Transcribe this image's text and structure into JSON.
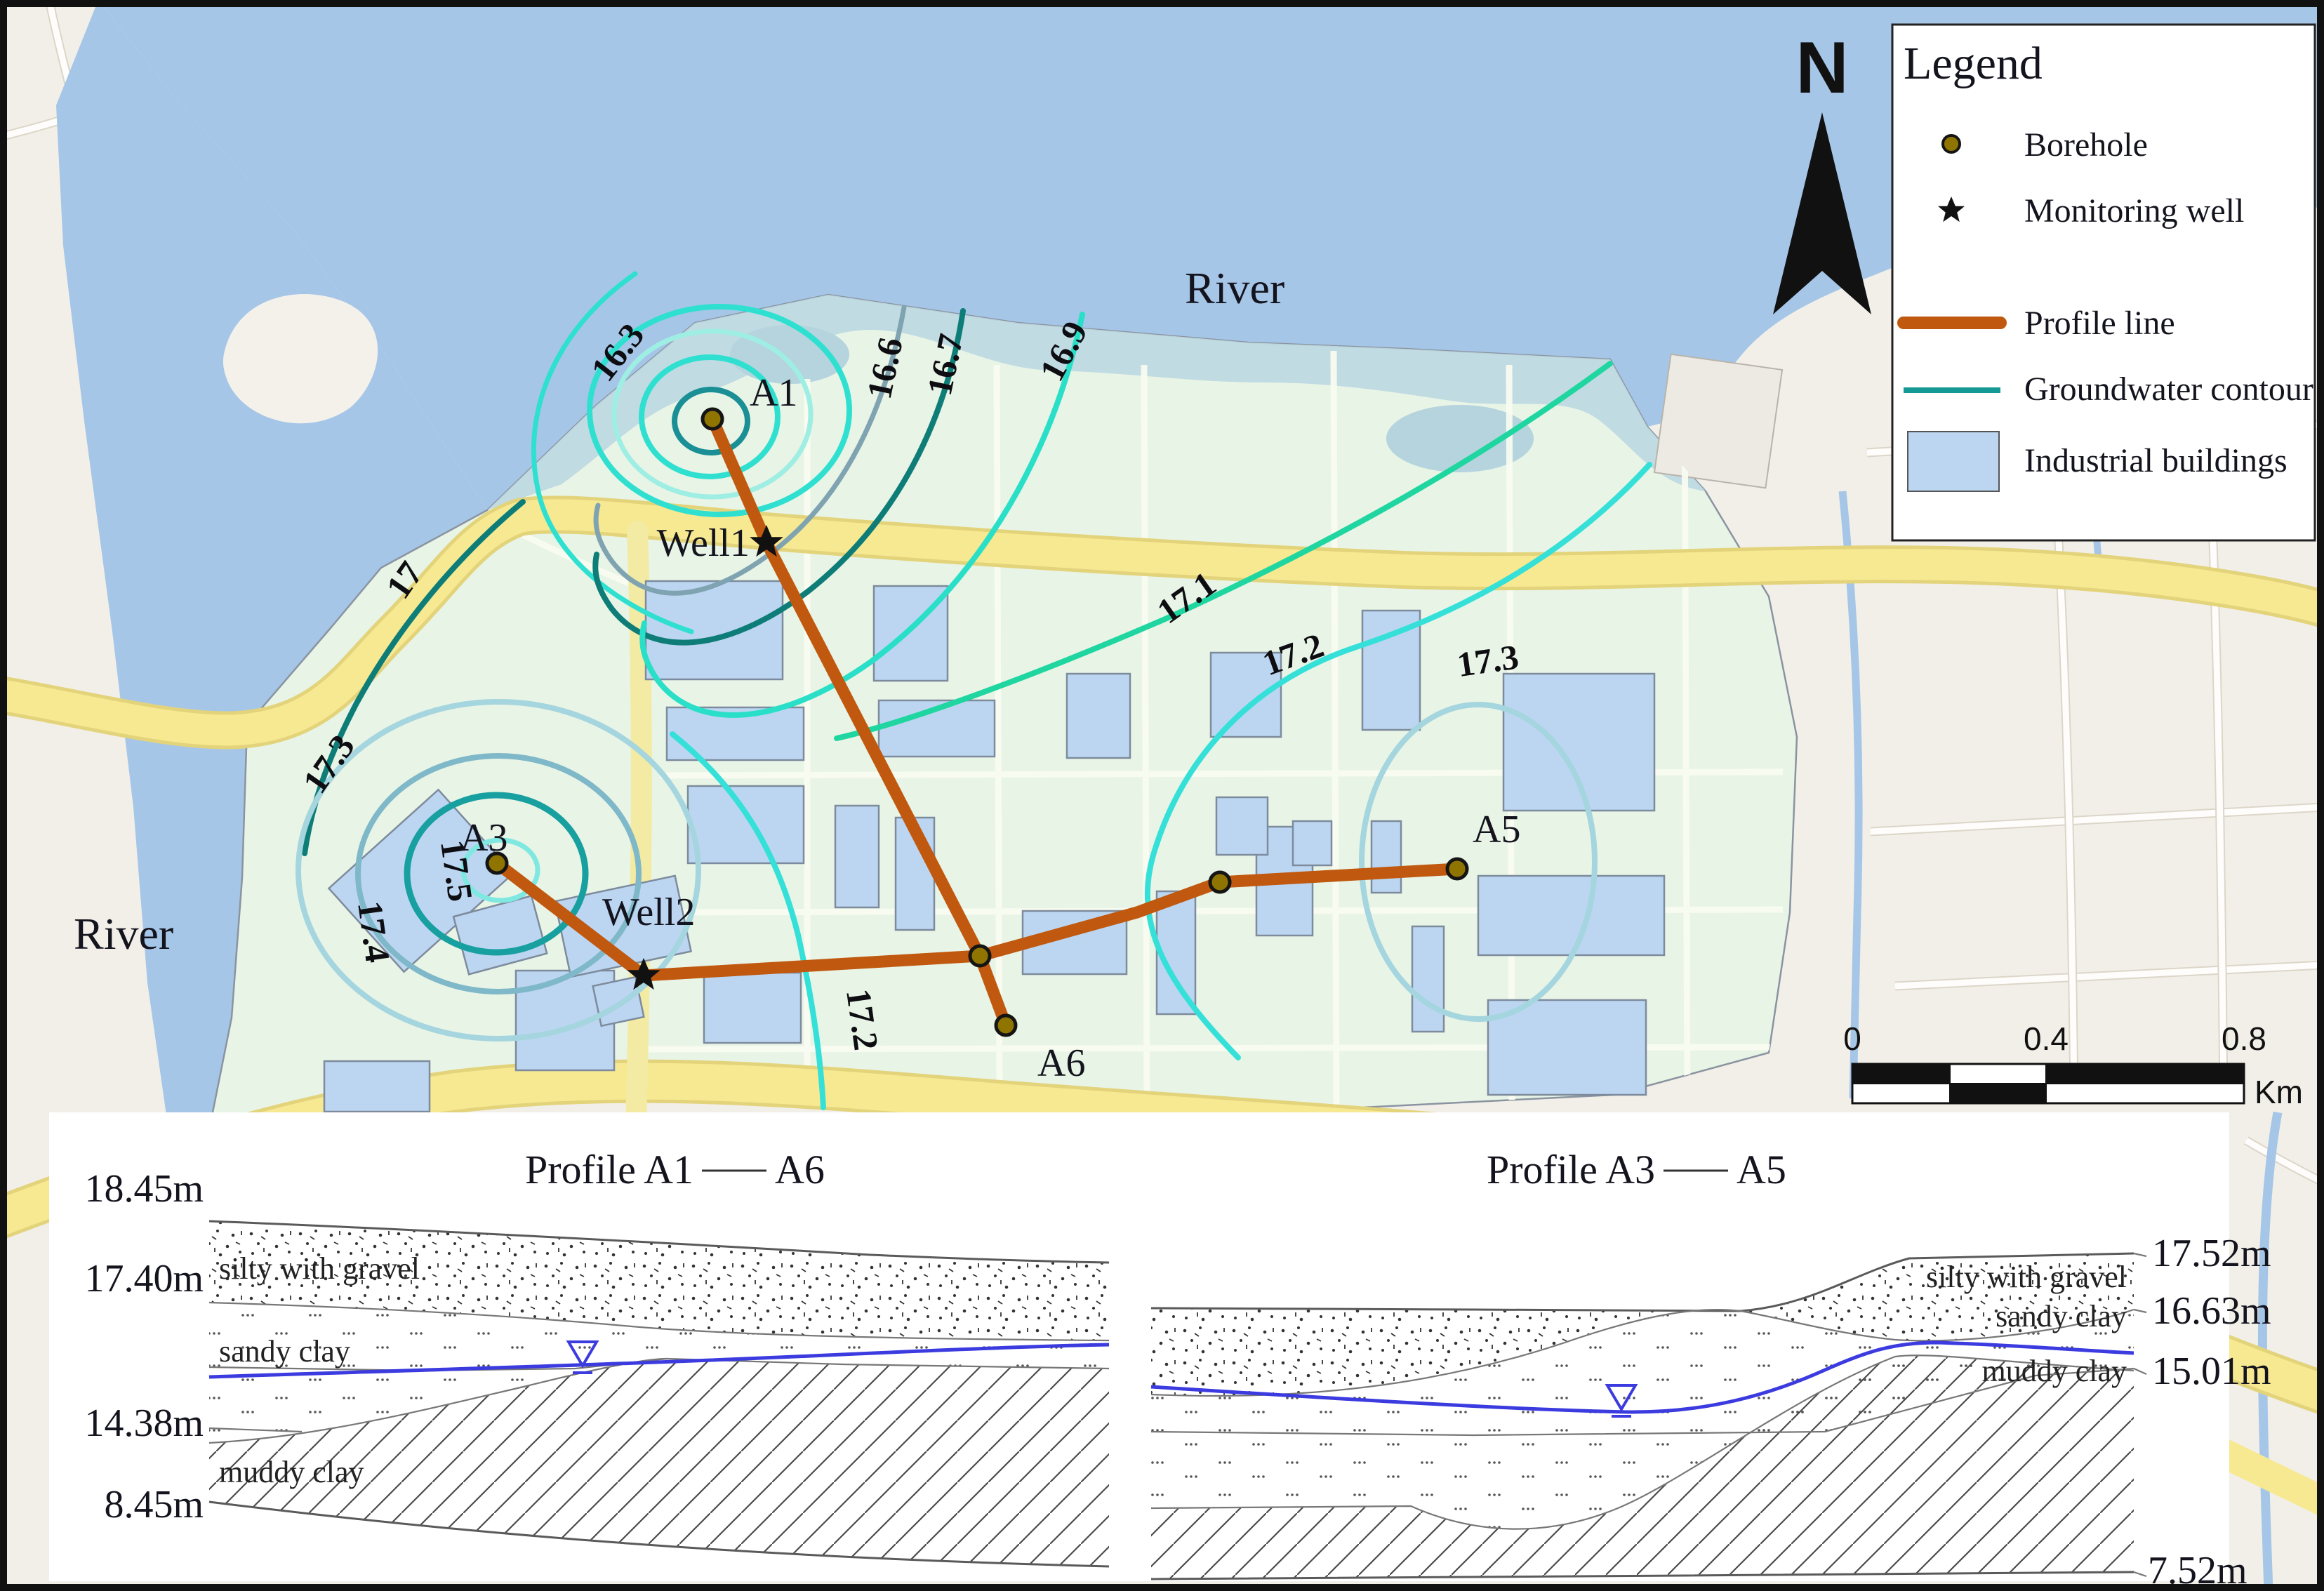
{
  "labels": {
    "river_top": "River",
    "river_left": "River",
    "north": "N"
  },
  "legend": {
    "title": "Legend",
    "items": [
      {
        "label": "Borehole"
      },
      {
        "label": "Monitoring well"
      },
      {
        "label": "Profile line"
      },
      {
        "label": "Groundwater contour"
      },
      {
        "label": "Industrial buildings"
      }
    ]
  },
  "map": {
    "points": [
      {
        "id": "A1",
        "label": "A1",
        "type": "borehole"
      },
      {
        "id": "Well1",
        "label": "Well1",
        "type": "monitoring-well"
      },
      {
        "id": "A3",
        "label": "A3",
        "type": "borehole"
      },
      {
        "id": "Well2",
        "label": "Well2",
        "type": "monitoring-well"
      },
      {
        "id": "A5",
        "label": "A5",
        "type": "borehole"
      },
      {
        "id": "A6",
        "label": "A6",
        "type": "borehole"
      }
    ],
    "contour_labels": [
      {
        "value": "16.3"
      },
      {
        "value": "16.6"
      },
      {
        "value": "16.7"
      },
      {
        "value": "16.9"
      },
      {
        "value": "17"
      },
      {
        "value": "17.1"
      },
      {
        "value": "17.2"
      },
      {
        "value": "17.2"
      },
      {
        "value": "17.3"
      },
      {
        "value": "17.3"
      },
      {
        "value": "17.4"
      },
      {
        "value": "17.5"
      }
    ]
  },
  "scalebar": {
    "ticks": [
      "0",
      "0.4",
      "0.8"
    ],
    "unit": "Km"
  },
  "profiles": {
    "left": {
      "title_left": "Profile A1",
      "title_right": "A6",
      "elevations": [
        "18.45m",
        "17.40m",
        "14.38m",
        "8.45m"
      ],
      "layers": [
        "silty with gravel",
        "sandy clay",
        "muddy clay"
      ]
    },
    "right": {
      "title_left": "Profile A3",
      "title_right": "A5",
      "elevations": [
        "17.52m",
        "16.63m",
        "15.01m",
        "7.52m"
      ],
      "layers": [
        "silty with gravel",
        "sandy clay",
        "muddy clay"
      ]
    }
  },
  "colors": {
    "profile_line": "#c0590f",
    "groundwater_contour": "#169a96",
    "industrial_building": "#bcd6f2",
    "river": "#a6c6e8",
    "study_area": "#e8f4e6",
    "road": "#f7e992",
    "water_table": "#3b3be0",
    "borehole": "#8f7500"
  }
}
